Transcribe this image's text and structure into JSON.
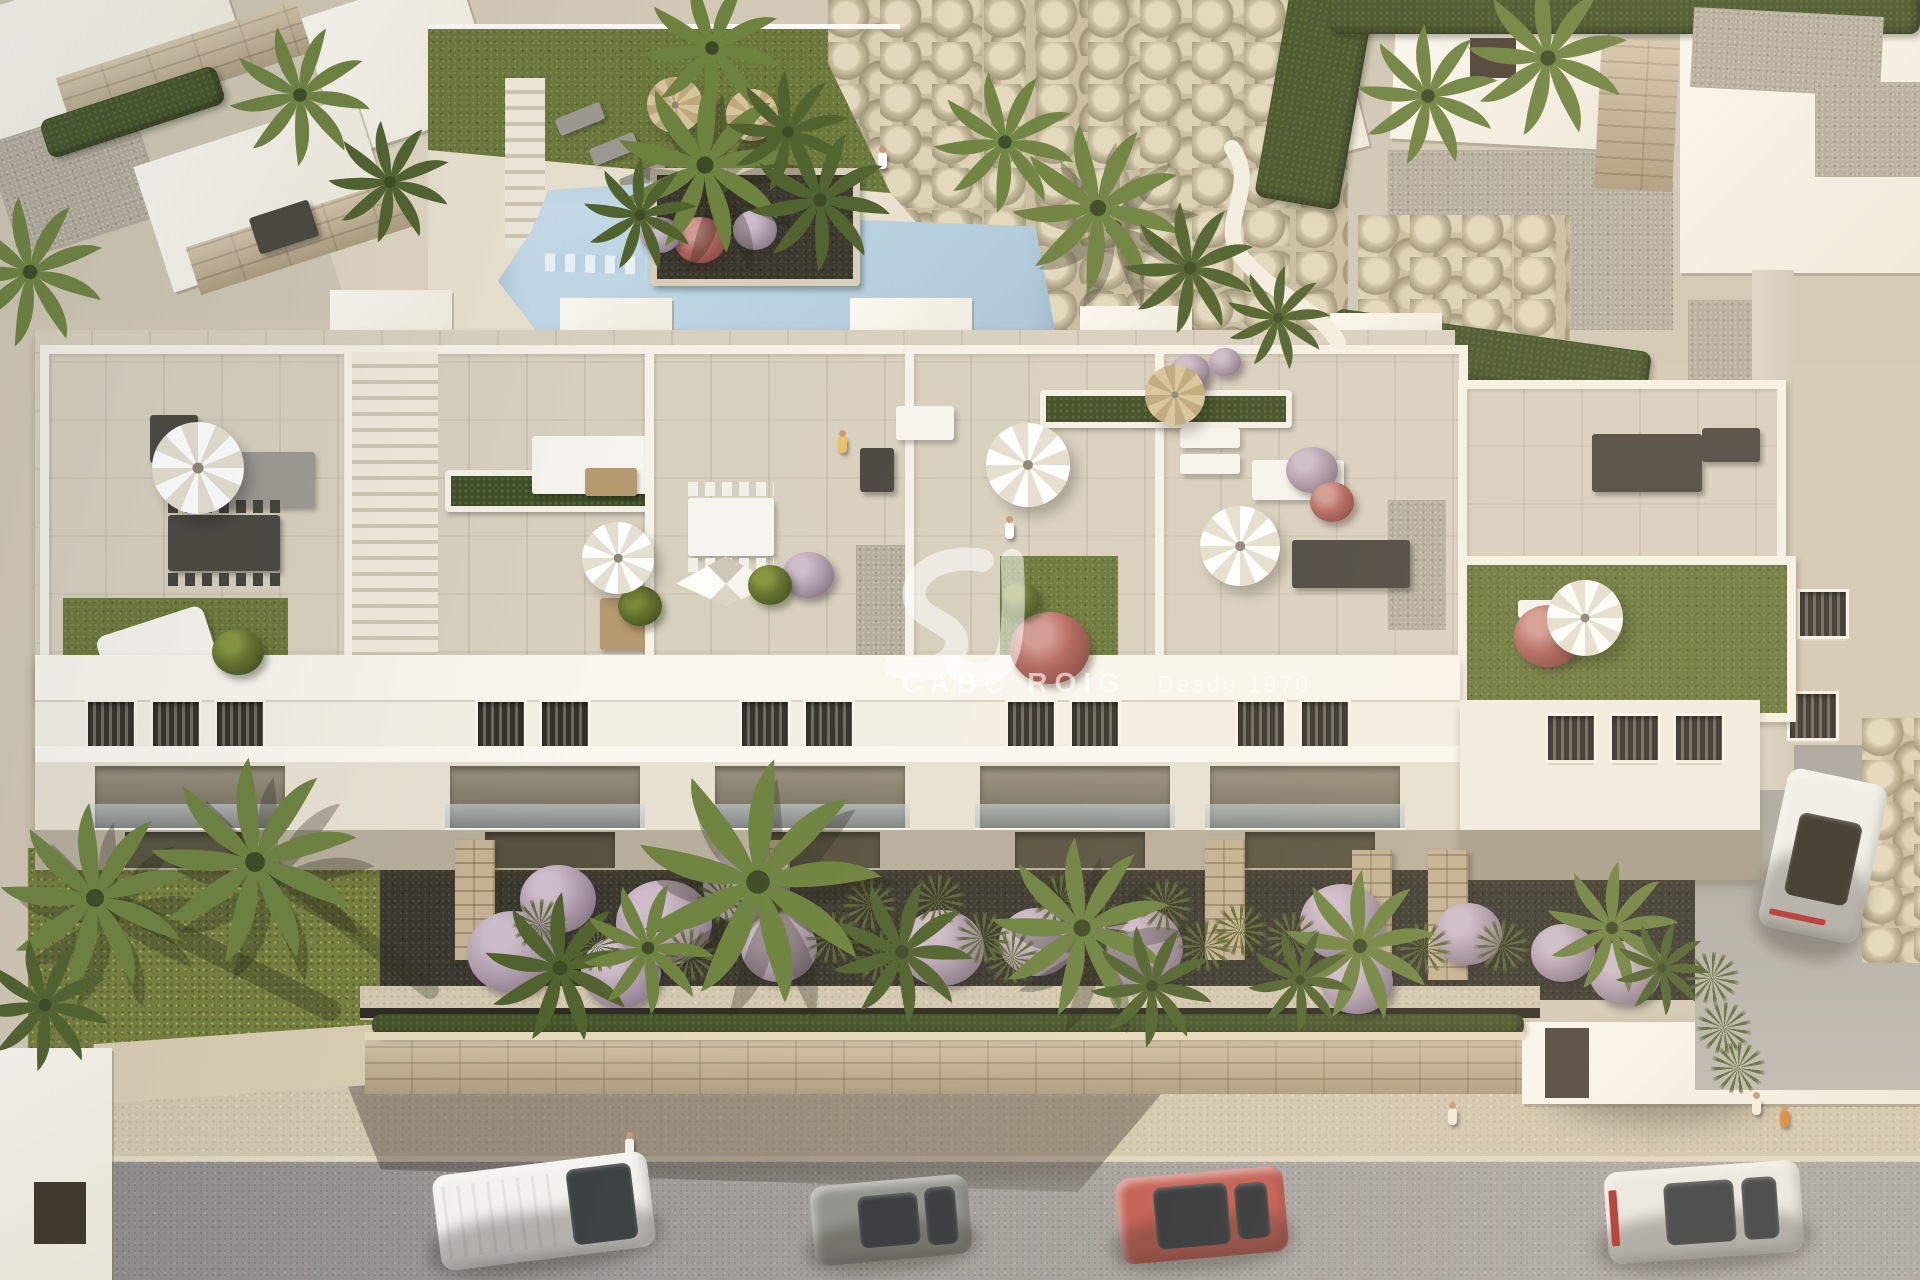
{
  "meta": {
    "description": "Aerial 3D architectural render of a white Mediterranean apartment complex with rooftop terraces, communal pool, gardens and street",
    "time_of_day": "late afternoon sunlight from the right"
  },
  "watermark": {
    "brand": "CABO ROIG",
    "tagline": "Desde 1970",
    "monogram": "sv-swoosh-logo",
    "color": "#ffffff"
  },
  "palette": {
    "ground": "#d3c9b6",
    "roofTile": "#d8d0bf",
    "lawn": "#6b783c",
    "mulch": "#3b382f",
    "pool": "#aac6d8",
    "poolLight": "#cadeea",
    "street": "#9f9c99",
    "sidewalk": "#d2c7af",
    "buildingWhite": "#f6f2e8",
    "buildingShade": "#ddd6c7",
    "stone": "#c9b795",
    "hedgeGreen": "#44532c",
    "furnitureDark": "#4b4741",
    "carRed": "#c25a50",
    "carGrey": "#8f918c",
    "carWhite": "#f2f1ed"
  },
  "scene": {
    "palms": [
      {
        "x": 758,
        "y": 882,
        "s": 2.6,
        "tone": "light"
      },
      {
        "x": 560,
        "y": 968,
        "s": 1.6,
        "tone": "dark"
      },
      {
        "x": 648,
        "y": 948,
        "s": 1.4,
        "tone": "light"
      },
      {
        "x": 902,
        "y": 952,
        "s": 1.5,
        "tone": "dark"
      },
      {
        "x": 1082,
        "y": 928,
        "s": 1.9,
        "tone": "light"
      },
      {
        "x": 1152,
        "y": 986,
        "s": 1.3,
        "tone": "dark"
      },
      {
        "x": 1360,
        "y": 946,
        "s": 1.6,
        "tone": "light"
      },
      {
        "x": 1300,
        "y": 980,
        "s": 1.1,
        "tone": "dark"
      },
      {
        "x": 95,
        "y": 898,
        "s": 2.0,
        "tone": "light"
      },
      {
        "x": 255,
        "y": 862,
        "s": 2.2,
        "tone": "light"
      },
      {
        "x": 45,
        "y": 1005,
        "s": 1.4,
        "tone": "dark"
      },
      {
        "x": 705,
        "y": 165,
        "s": 1.9,
        "tone": "light"
      },
      {
        "x": 820,
        "y": 200,
        "s": 1.5,
        "tone": "dark"
      },
      {
        "x": 640,
        "y": 215,
        "s": 1.2,
        "tone": "dark"
      },
      {
        "x": 1005,
        "y": 142,
        "s": 1.5,
        "tone": "light"
      },
      {
        "x": 1098,
        "y": 208,
        "s": 1.8,
        "tone": "light"
      },
      {
        "x": 1190,
        "y": 268,
        "s": 1.4,
        "tone": "dark"
      },
      {
        "x": 300,
        "y": 95,
        "s": 1.5,
        "tone": "light"
      },
      {
        "x": 390,
        "y": 182,
        "s": 1.3,
        "tone": "dark"
      },
      {
        "x": 30,
        "y": 272,
        "s": 1.6,
        "tone": "light"
      },
      {
        "x": 712,
        "y": 48,
        "s": 1.5,
        "tone": "light"
      },
      {
        "x": 788,
        "y": 132,
        "s": 1.3,
        "tone": "dark"
      },
      {
        "x": 1428,
        "y": 96,
        "s": 1.5,
        "tone": "light"
      },
      {
        "x": 1548,
        "y": 58,
        "s": 1.7,
        "tone": "light"
      },
      {
        "x": 1278,
        "y": 318,
        "s": 1.1,
        "tone": "dark"
      },
      {
        "x": 1612,
        "y": 928,
        "s": 1.4,
        "tone": "light"
      },
      {
        "x": 1662,
        "y": 968,
        "s": 1.0,
        "tone": "dark"
      }
    ],
    "bushes": [
      {
        "x": 513,
        "y": 952,
        "r": 46,
        "c": "lilac"
      },
      {
        "x": 558,
        "y": 899,
        "r": 38,
        "c": "lilac"
      },
      {
        "x": 621,
        "y": 972,
        "r": 40,
        "c": "lilac"
      },
      {
        "x": 664,
        "y": 923,
        "r": 48,
        "c": "lilac"
      },
      {
        "x": 745,
        "y": 886,
        "r": 42,
        "c": "lilac"
      },
      {
        "x": 779,
        "y": 948,
        "r": 38,
        "c": "lilac"
      },
      {
        "x": 942,
        "y": 948,
        "r": 42,
        "c": "lilac"
      },
      {
        "x": 1037,
        "y": 942,
        "r": 38,
        "c": "lilac"
      },
      {
        "x": 1137,
        "y": 948,
        "r": 46,
        "c": "lilac"
      },
      {
        "x": 1342,
        "y": 922,
        "r": 42,
        "c": "lilac"
      },
      {
        "x": 1357,
        "y": 982,
        "r": 36,
        "c": "lilac"
      },
      {
        "x": 1468,
        "y": 934,
        "r": 34,
        "c": "lilac"
      },
      {
        "x": 1563,
        "y": 953,
        "r": 32,
        "c": "lilac"
      },
      {
        "x": 1625,
        "y": 973,
        "r": 36,
        "c": "lilac"
      },
      {
        "x": 1050,
        "y": 648,
        "r": 40,
        "c": "pink"
      },
      {
        "x": 1548,
        "y": 636,
        "r": 34,
        "c": "pink"
      },
      {
        "x": 238,
        "y": 652,
        "r": 26,
        "c": "green"
      },
      {
        "x": 640,
        "y": 606,
        "r": 22,
        "c": "green"
      },
      {
        "x": 808,
        "y": 575,
        "r": 26,
        "c": "lilac"
      },
      {
        "x": 770,
        "y": 585,
        "r": 22,
        "c": "green"
      },
      {
        "x": 700,
        "y": 240,
        "r": 26,
        "c": "pink"
      },
      {
        "x": 755,
        "y": 230,
        "r": 22,
        "c": "lilac"
      },
      {
        "x": 660,
        "y": 235,
        "r": 20,
        "c": "lilac"
      },
      {
        "x": 1312,
        "y": 470,
        "r": 26,
        "c": "lilac"
      },
      {
        "x": 1332,
        "y": 502,
        "r": 22,
        "c": "pink"
      },
      {
        "x": 1190,
        "y": 372,
        "r": 20,
        "c": "lilac"
      },
      {
        "x": 1225,
        "y": 362,
        "r": 16,
        "c": "lilac"
      },
      {
        "x": 1020,
        "y": 600,
        "r": 20,
        "c": "green"
      }
    ],
    "grasses": [
      {
        "x": 540,
        "y": 925
      },
      {
        "x": 597,
        "y": 946
      },
      {
        "x": 690,
        "y": 955
      },
      {
        "x": 724,
        "y": 898
      },
      {
        "x": 832,
        "y": 938
      },
      {
        "x": 880,
        "y": 957
      },
      {
        "x": 983,
        "y": 938
      },
      {
        "x": 1012,
        "y": 958
      },
      {
        "x": 1102,
        "y": 928
      },
      {
        "x": 1205,
        "y": 946
      },
      {
        "x": 1292,
        "y": 938
      },
      {
        "x": 1424,
        "y": 948
      },
      {
        "x": 1502,
        "y": 946
      },
      {
        "x": 870,
        "y": 905
      },
      {
        "x": 938,
        "y": 900
      },
      {
        "x": 1060,
        "y": 900
      },
      {
        "x": 1240,
        "y": 930
      },
      {
        "x": 1165,
        "y": 905
      },
      {
        "x": 1712,
        "y": 978
      },
      {
        "x": 1724,
        "y": 1028
      },
      {
        "x": 1738,
        "y": 1068
      }
    ],
    "umbrellas": [
      {
        "x": 198,
        "y": 468,
        "r": 46,
        "c": "white"
      },
      {
        "x": 618,
        "y": 558,
        "r": 36,
        "c": "white"
      },
      {
        "x": 1028,
        "y": 465,
        "r": 42,
        "c": "white"
      },
      {
        "x": 1240,
        "y": 546,
        "r": 40,
        "c": "white"
      },
      {
        "x": 675,
        "y": 105,
        "r": 28,
        "c": "tan"
      },
      {
        "x": 752,
        "y": 115,
        "r": 26,
        "c": "tan"
      },
      {
        "x": 1175,
        "y": 395,
        "r": 30,
        "c": "tan"
      },
      {
        "x": 1585,
        "y": 618,
        "r": 38,
        "c": "white"
      }
    ],
    "people": [
      {
        "x": 625,
        "y": 1138,
        "c": "#f3f1ea",
        "role": "pedestrian"
      },
      {
        "x": 1448,
        "y": 1108,
        "c": "#f3ead8",
        "role": "pedestrian-with-bags"
      },
      {
        "x": 1752,
        "y": 1098,
        "c": "#f6efe2",
        "role": "pedestrian"
      },
      {
        "x": 1780,
        "y": 1110,
        "c": "#d98b3a",
        "role": "child"
      },
      {
        "x": 838,
        "y": 436,
        "c": "#e8c26a",
        "role": "resident-on-terrace"
      },
      {
        "x": 1005,
        "y": 522,
        "c": "#ffffff",
        "role": "resident-on-roof-lawn"
      },
      {
        "x": 878,
        "y": 152,
        "c": "#ffffff",
        "role": "walker-upper-path"
      }
    ],
    "cars": [
      {
        "name": "white-van",
        "x": 436,
        "y": 1163,
        "w": 216,
        "h": 96,
        "rot": -7,
        "body": "#f2f1ed",
        "glassColor": "#3a3f41",
        "glass": [
          [
            62,
            10,
            30,
            80
          ]
        ],
        "ridges": [
          4,
          12,
          54,
          76
        ]
      },
      {
        "name": "grey-hatchback",
        "x": 812,
        "y": 1180,
        "w": 158,
        "h": 80,
        "rot": -5,
        "body": "#8f918c",
        "glassColor": "#33373a",
        "glass": [
          [
            30,
            18,
            38,
            64
          ],
          [
            72,
            14,
            20,
            72
          ]
        ]
      },
      {
        "name": "red-hatchback",
        "x": 1118,
        "y": 1172,
        "w": 168,
        "h": 86,
        "rot": -5,
        "body": "#c25a50",
        "glassColor": "#2f3336",
        "glass": [
          [
            22,
            14,
            44,
            72
          ],
          [
            70,
            18,
            20,
            64
          ]
        ]
      },
      {
        "name": "white-sedan",
        "x": 1606,
        "y": 1166,
        "w": 196,
        "h": 92,
        "rot": -4,
        "body": "#ebe9e4",
        "glassColor": "#3c4042",
        "glass": [
          [
            30,
            16,
            36,
            68
          ],
          [
            70,
            16,
            18,
            68
          ]
        ],
        "accent": [
          [
            2,
            20,
            4,
            60
          ],
          "#b4342e"
        ]
      },
      {
        "name": "white-cabrio-driveway",
        "x": 1772,
        "y": 775,
        "w": 102,
        "h": 162,
        "rot": 12,
        "body": "#f0efeb",
        "glassColor": "#332f28",
        "glass": [
          [
            20,
            26,
            62,
            52
          ]
        ],
        "accent": [
          [
            10,
            88,
            56,
            4
          ],
          "#b4342e"
        ]
      }
    ]
  }
}
